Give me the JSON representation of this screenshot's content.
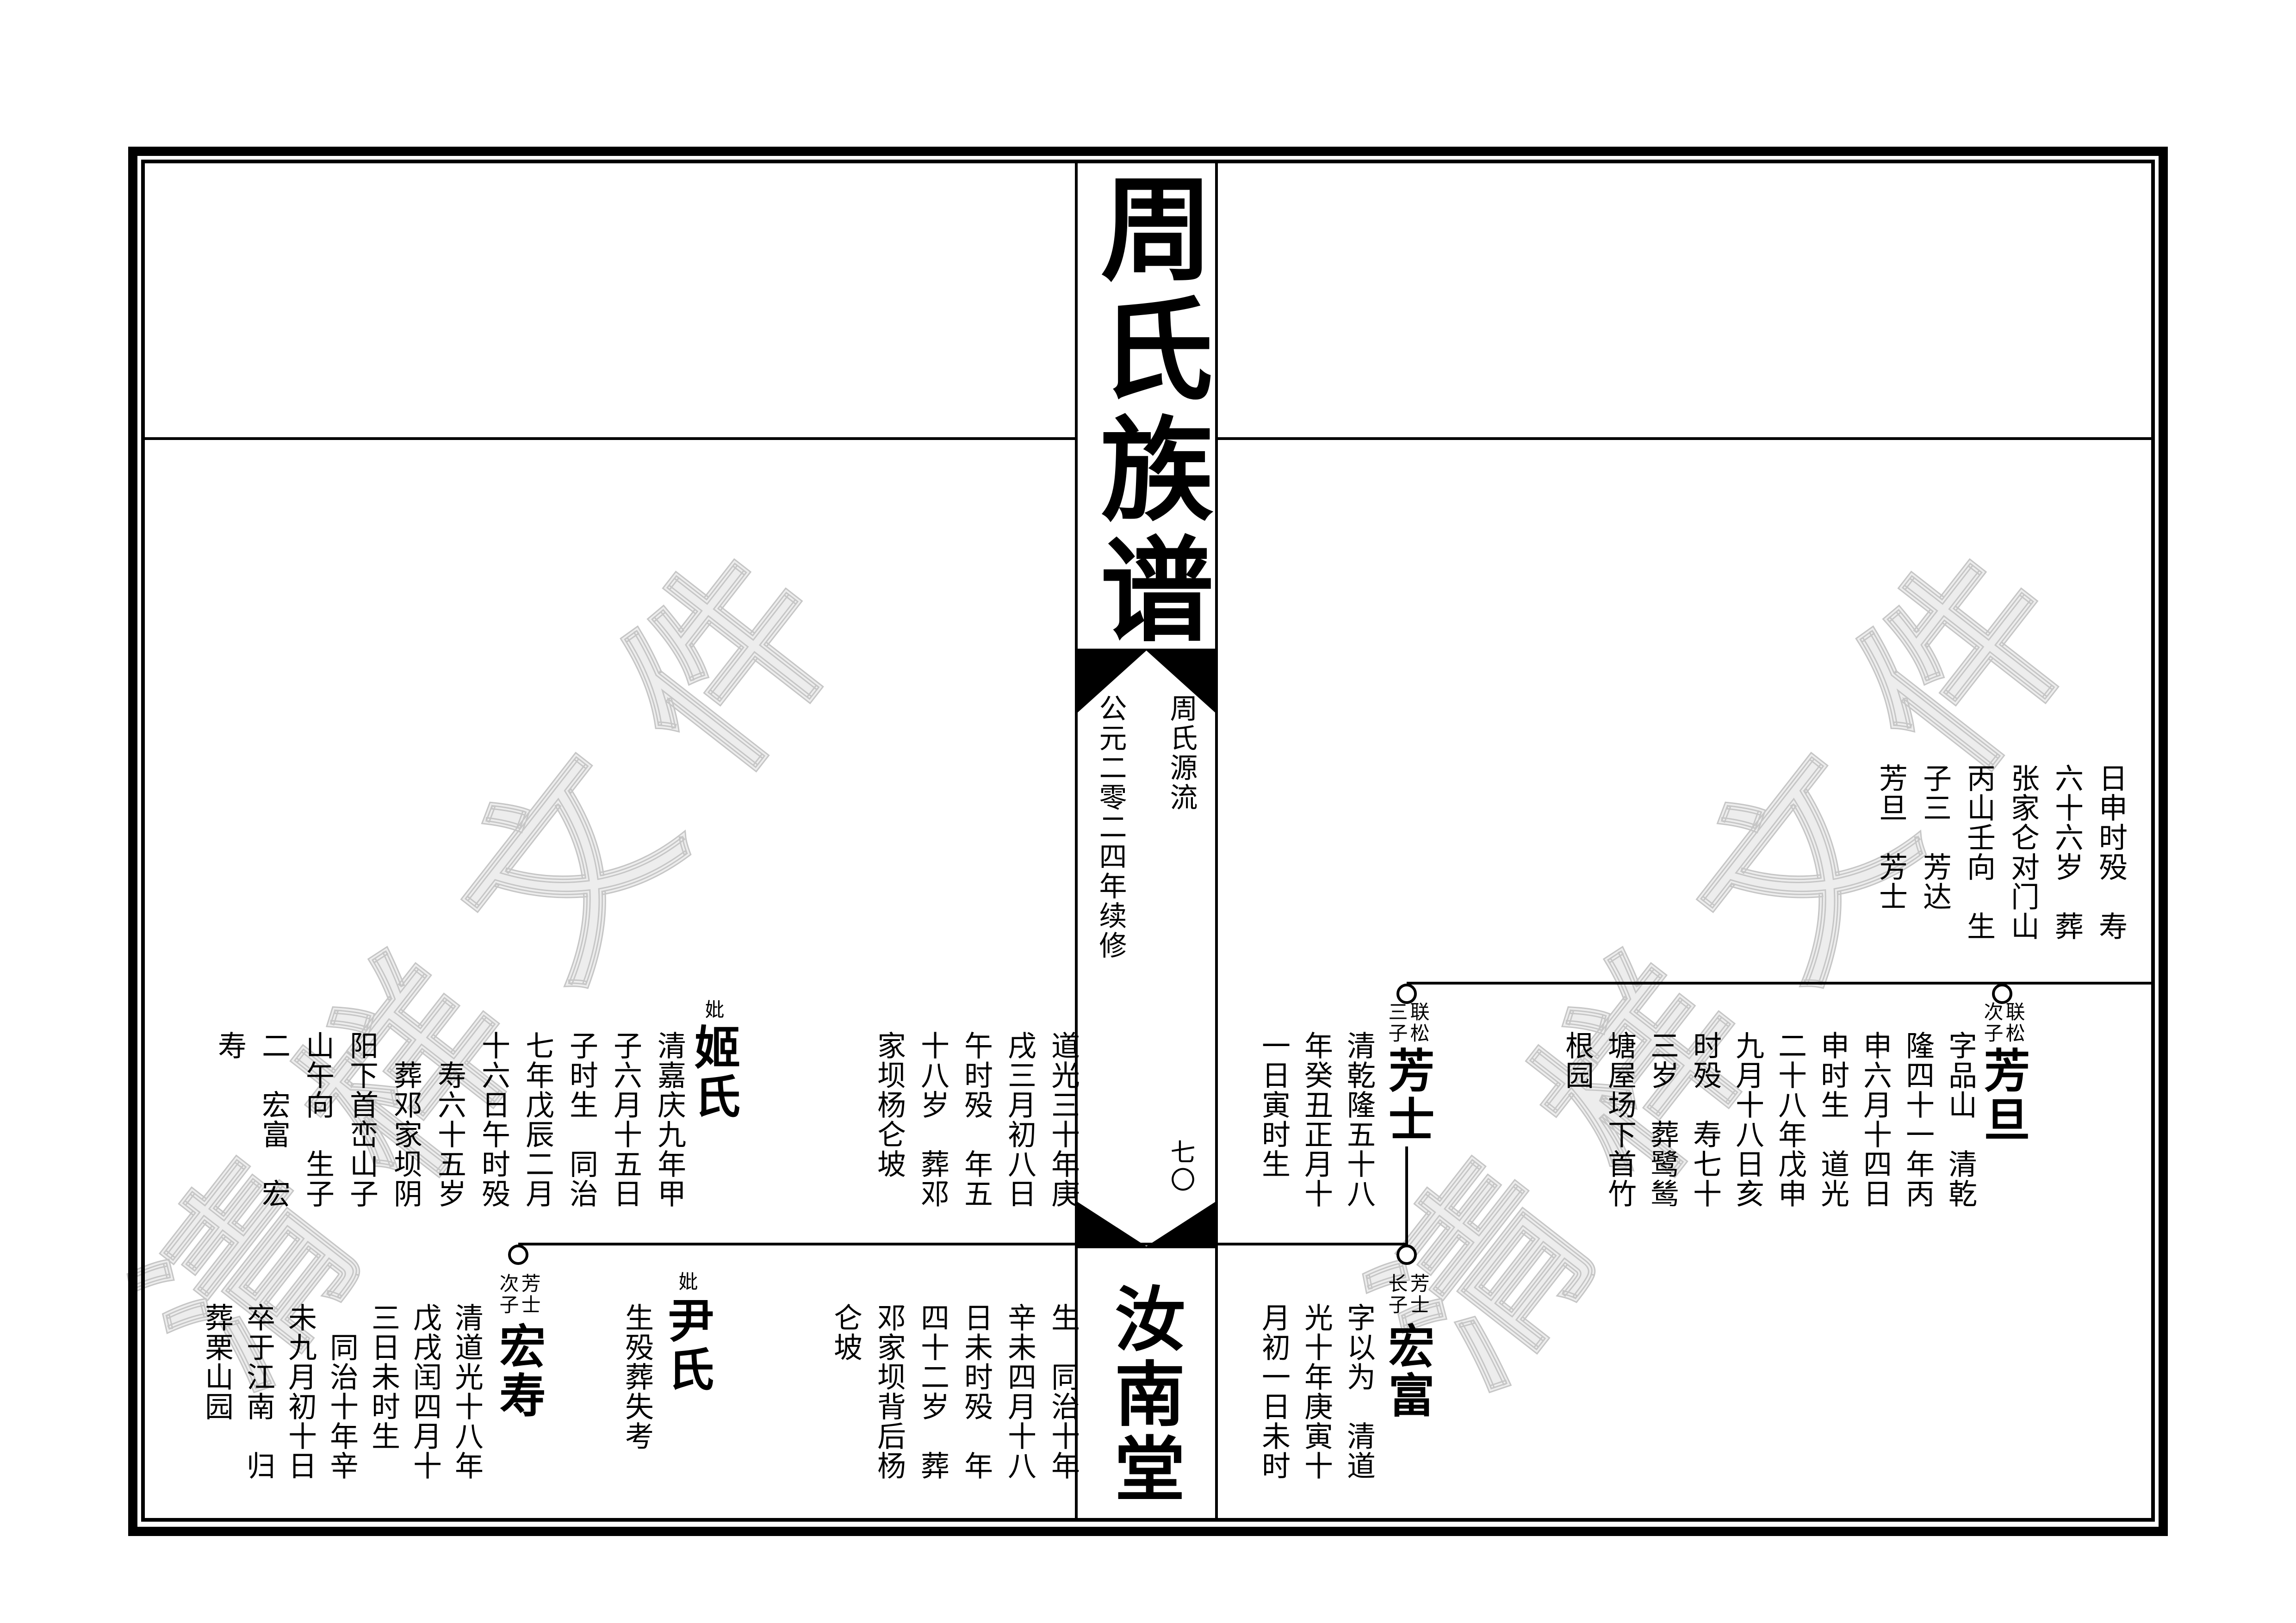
{
  "page": {
    "book_title": "周氏族谱",
    "spine": {
      "section_label": "周氏源流",
      "edition_note": "公元二零二四年续修",
      "page_number": "七〇",
      "hall_name": "汝南堂"
    },
    "watermark": {
      "text": "清样文件",
      "fill_color": "#ededed",
      "outline_color": "#c6c6c6"
    },
    "colors": {
      "ink": "#000000",
      "paper": "#ffffff"
    }
  },
  "ancestor_continuation_columns": [
    "日申时殁　寿",
    "六十六岁　葬",
    "张家仑对门山",
    "丙山壬向　生",
    "子三　芳达",
    "芳旦　芳士"
  ],
  "persons": [
    {
      "id": "fangdan",
      "name": "芳旦",
      "relation_label": [
        "联松",
        "次子"
      ],
      "bio_columns": [
        "字品山　清乾",
        "隆四十一年丙",
        "申六月十四日",
        "申时生　道光",
        "二十八年戊申",
        "九月十八日亥",
        "时殁　寿七十",
        "三岁　葬鹭鸶",
        "塘屋场下首竹",
        "根园"
      ]
    },
    {
      "id": "fangshi",
      "name": "芳士",
      "relation_label": [
        "联松",
        "三子"
      ],
      "bio_columns": [
        "清乾隆五十八",
        "年癸丑正月十",
        "一日寅时生",
        "道光三十年庚",
        "戌三月初八日",
        "午时殁　年五",
        "十八岁　葬邓",
        "家坝杨仑坡"
      ]
    },
    {
      "id": "jishi",
      "name": "姬氏",
      "relation_label": [
        "妣"
      ],
      "bio_columns": [
        "清嘉庆九年甲",
        "子六月十五日",
        "子时生　同治",
        "七年戊辰二月",
        "十六日午时殁",
        "　寿六十五岁",
        "　葬邓家坝阴",
        "阳下首峦山子",
        "山午向　生子",
        "二　宏富　宏",
        "寿"
      ]
    },
    {
      "id": "hongfu",
      "name": "宏富",
      "relation_label": [
        "芳士",
        "长子"
      ],
      "bio_columns": [
        "字以为　清道",
        "光十年庚寅十",
        "月初一日未时",
        "生　同治十年",
        "辛未四月十八",
        "日未时殁　年",
        "四十二岁　葬",
        "邓家坝背后杨",
        "仑坡"
      ]
    },
    {
      "id": "yinshi",
      "name": "尹氏",
      "relation_label": [
        "妣"
      ],
      "bio_columns": [
        "生殁葬失考"
      ]
    },
    {
      "id": "hongshou",
      "name": "宏寿",
      "relation_label": [
        "芳士",
        "次子"
      ],
      "bio_columns": [
        "清道光十八年",
        "戊戌闰四月十",
        "三日未时生",
        "　同治十年辛",
        "未九月初十日",
        "卒于江南　归",
        "葬栗山园"
      ]
    }
  ]
}
